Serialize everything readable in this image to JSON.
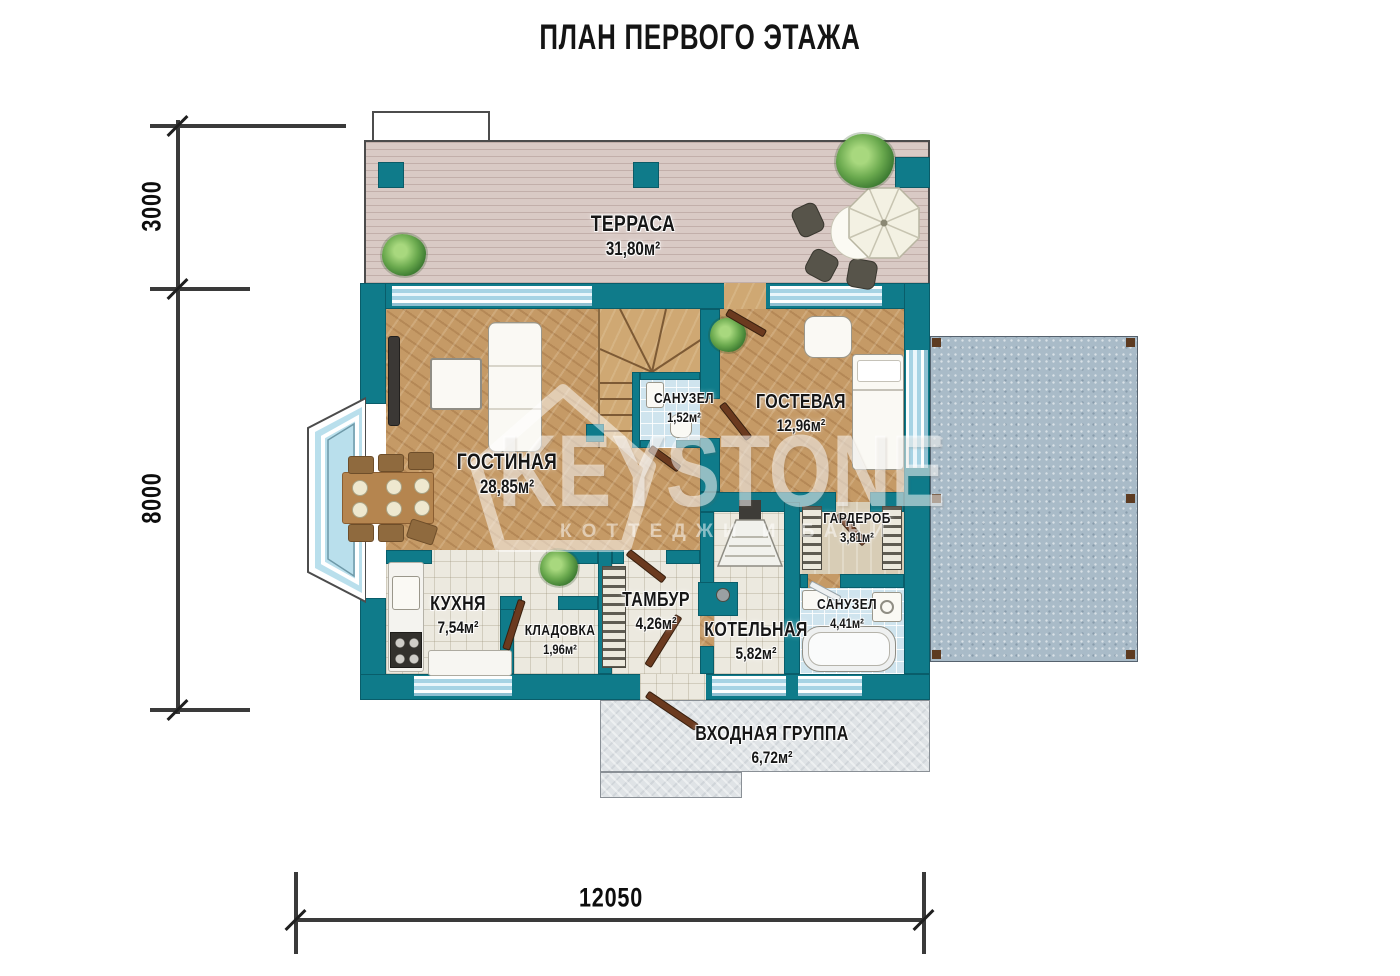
{
  "title": "ПЛАН ПЕРВОГО ЭТАЖА",
  "watermark": {
    "brand": "KEYSTONE",
    "tagline": "КОТТЕДЖИ И БАНИ"
  },
  "dimensions": {
    "side_top": "3000",
    "side_main": "8000",
    "bottom": "12050"
  },
  "rooms": [
    {
      "id": "terrace",
      "name": "ТЕРРАСА",
      "area": "31,80м²"
    },
    {
      "id": "living-room",
      "name": "ГОСТИНАЯ",
      "area": "28,85м²"
    },
    {
      "id": "bathroom-small",
      "name": "САНУЗЕЛ",
      "area": "1,52м²"
    },
    {
      "id": "guest-room",
      "name": "ГОСТЕВАЯ",
      "area": "12,96м²"
    },
    {
      "id": "wardrobe",
      "name": "ГАРДЕРОБ",
      "area": "3,81м²"
    },
    {
      "id": "bathroom",
      "name": "САНУЗЕЛ",
      "area": "4,41м²"
    },
    {
      "id": "kitchen",
      "name": "КУХНЯ",
      "area": "7,54м²"
    },
    {
      "id": "storage",
      "name": "КЛАДОВКА",
      "area": "1,96м²"
    },
    {
      "id": "vestibule",
      "name": "ТАМБУР",
      "area": "4,26м²"
    },
    {
      "id": "boiler-room",
      "name": "КОТЕЛЬНАЯ",
      "area": "5,82м²"
    },
    {
      "id": "entrance-group",
      "name": "ВХОДНАЯ ГРУППА",
      "area": "6,72м²"
    }
  ],
  "colors": {
    "wall": "#0f7b8a",
    "door": "#6b3a1f",
    "wood_floor": "#c59a66",
    "terrace_deck": "#d9cac5",
    "blue_pad": "#a9bbc8",
    "bathroom_tile": "#cfe4ee",
    "dimension_line": "#3a3a3a"
  }
}
